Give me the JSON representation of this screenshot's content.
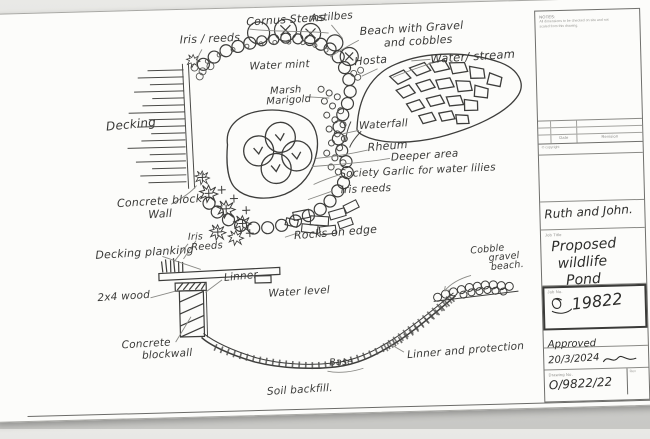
{
  "plan": {
    "iris_reeds": "Iris / reeds",
    "cornus_stems": "Cornus Stems",
    "astilbes": "Astilbes",
    "beach_line1": "Beach with Gravel",
    "beach_line2": "and cobbles",
    "water_mint": "Water mint",
    "hosta": "Hosta",
    "water_stream": "Water/ stream",
    "marsh_line1": "Marsh",
    "marsh_line2": "Marigold",
    "decking": "Decking",
    "waterfall": "Waterfall",
    "rheum": "Rheum",
    "deeper_area": "Deeper area",
    "society_garlic": "Society Garlic for water lilies",
    "iris_reeds_2": "Iris reeds",
    "concrete_line1": "Concrete block",
    "concrete_line2": "Wall",
    "rocks_on_edge": "Rocks on edge"
  },
  "section": {
    "iris": "Iris",
    "reeds": "Reeds",
    "decking_planking": "Decking planking",
    "liner": "Linner",
    "wood": "2x4 wood",
    "water_level": "Water level",
    "concrete_line1": "Concrete",
    "concrete_line2": "blockwall",
    "cobble_line1": "Cobble",
    "cobble_line2": "gravel",
    "cobble_line3": "beach.",
    "liner_protection": "Linner and protection",
    "base": "Base",
    "soil_backfill": "Soil backfill."
  },
  "title_block": {
    "notes_title": "NOTES:",
    "notes_line1": "All dimensions to be checked on site and not",
    "notes_line2": "scaled from this drawing.",
    "rev_col_date": "Date",
    "rev_col_revision": "Revision",
    "copyright": "© copyright",
    "client": "Ruth and John.",
    "job_title_label": "Job Title",
    "job_title": [
      "Proposed",
      "wildlife",
      "Pond"
    ],
    "job_no_label": "Job No.",
    "job_number": "19822",
    "approved": "Approved",
    "date": "20/3/2024",
    "drawing_no_label": "Drawing No.",
    "drawing_number": "O/9822/22",
    "rev_label": "Rev"
  }
}
